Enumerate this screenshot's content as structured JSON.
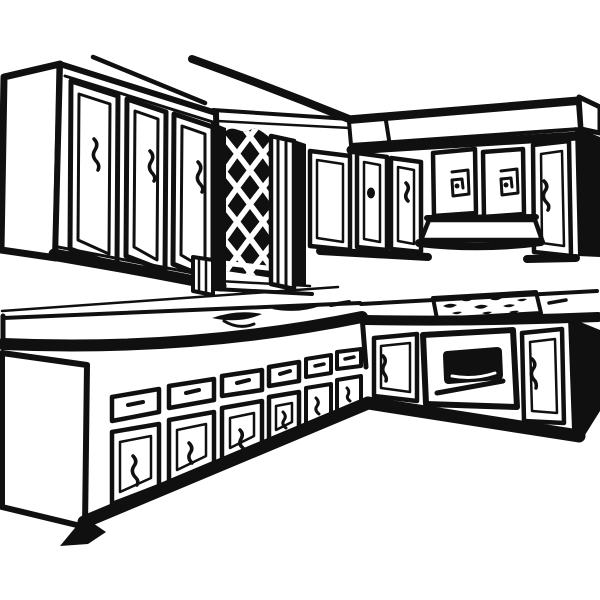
{
  "illustration": {
    "title": "Kitchen clip art — black and white line drawing",
    "aria_label": "Black and white line-art illustration of an L-shaped kitchen: upper cabinets on two walls, a diamond-lattice panel, a range hood, countertops with a sink and cooktop, an oven, and base cabinets with drawers and doors",
    "style": "black ink outlines on white background",
    "ink_color": "#101010",
    "background_color": "#ffffff",
    "parts": {
      "ceiling_lines": "ceiling trim strokes, upper left",
      "upper_cabinets_left": {
        "name": "upper cabinet bank, left wall",
        "doors": 3,
        "handle_style": "squiggle"
      },
      "lattice_panel": {
        "name": "diamond lattice panel with striped posts"
      },
      "upper_cabinets_right": {
        "name": "upper cabinet run, right wall",
        "doors": 6,
        "handle_styles": [
          "plain",
          "dot",
          "squiggle",
          "square-spiral",
          "square-spiral",
          "squiggle"
        ]
      },
      "range_hood": {
        "name": "range hood under upper cabinets"
      },
      "countertop_left": {
        "name": "left countertop",
        "features": [
          "sink basins",
          "faucet"
        ]
      },
      "countertop_right": {
        "name": "right countertop",
        "features": [
          "cooktop burner scribbles"
        ]
      },
      "oven": {
        "name": "oven with black window and handle bar"
      },
      "base_cabinets_left": {
        "name": "base cabinet run, left",
        "drawers": 6,
        "doors": 6
      },
      "base_cabinets_right": {
        "name": "base cabinet run, right",
        "doors": 2,
        "appliance": "oven"
      }
    }
  }
}
